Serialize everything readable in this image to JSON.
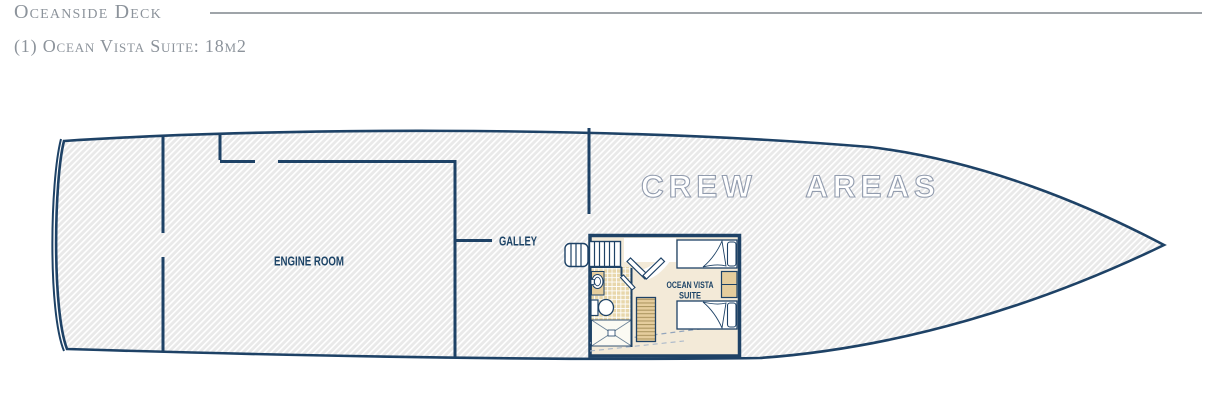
{
  "header": {
    "title": "Oceanside Deck",
    "subtitle": "(1) Ocean Vista Suite: 18m2"
  },
  "plan": {
    "labels": {
      "engine_room": "ENGINE ROOM",
      "galley": "GALLEY",
      "crew_areas": "CREW AREAS",
      "suite_line1": "OCEAN VISTA",
      "suite_line2": "SUITE"
    },
    "colors": {
      "wall_navy": "#1d4467",
      "hull_fill_gray": "#e9e9e9",
      "hatch_line": "#ffffff",
      "cabin_floor_cream": "#f3ead8",
      "bathroom_tile_tan": "#e8d7ab",
      "wood_tan": "#e5cd9d",
      "crew_text_outline": "#929cae",
      "header_text_gray": "#8c939b",
      "header_rule_gray": "#9fa4a9"
    }
  }
}
